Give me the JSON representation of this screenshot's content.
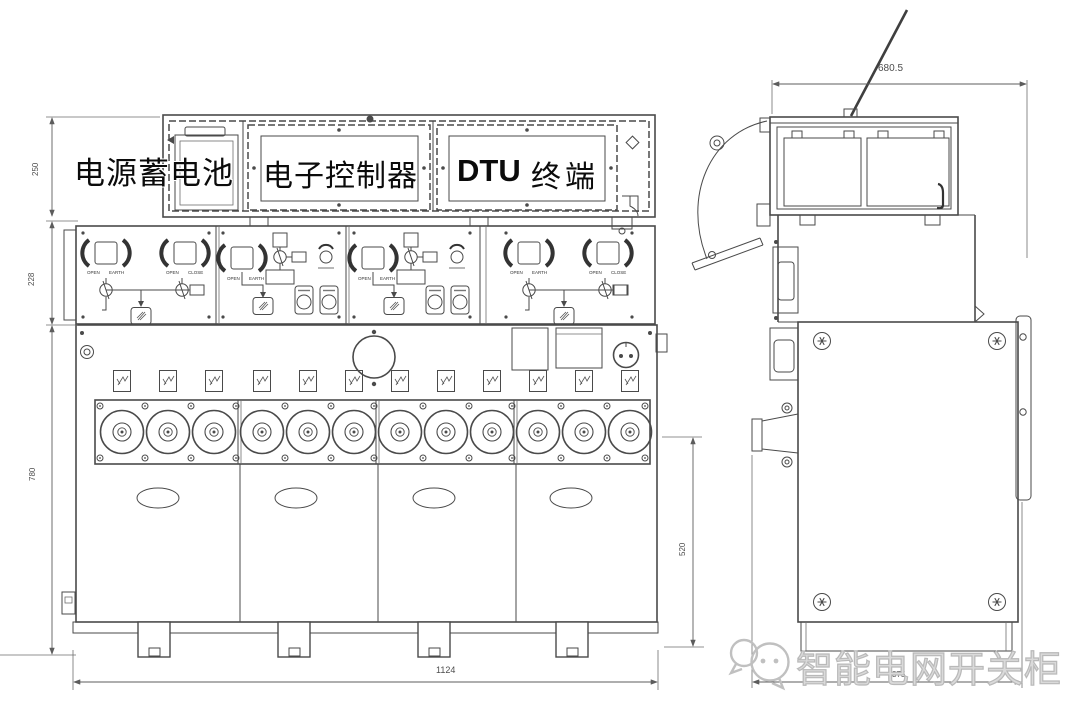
{
  "front_view": {
    "labels": {
      "battery": "电源蓄电池",
      "controller": "电子控制器",
      "dtu_latin": "DTU",
      "dtu_cn": "终端"
    },
    "switch_labels": {
      "open": "OPEN",
      "earth": "EARTH",
      "close": "CLOSE"
    },
    "dimensions": {
      "top_box_height": "250",
      "panel_row_height": "228",
      "body_height": "780",
      "overall_width": "1124"
    }
  },
  "side_view": {
    "dimensions": {
      "top_box_width": "680.5",
      "body_height": "520",
      "base_depth": "375"
    }
  },
  "watermark": {
    "text": "智能电网开关柜"
  },
  "colors": {
    "line": "#4a4a4a",
    "dim_line": "#5c5c5c",
    "label_text": "#0b0b0b",
    "watermark": "#bfbfbf",
    "background": "#ffffff"
  }
}
